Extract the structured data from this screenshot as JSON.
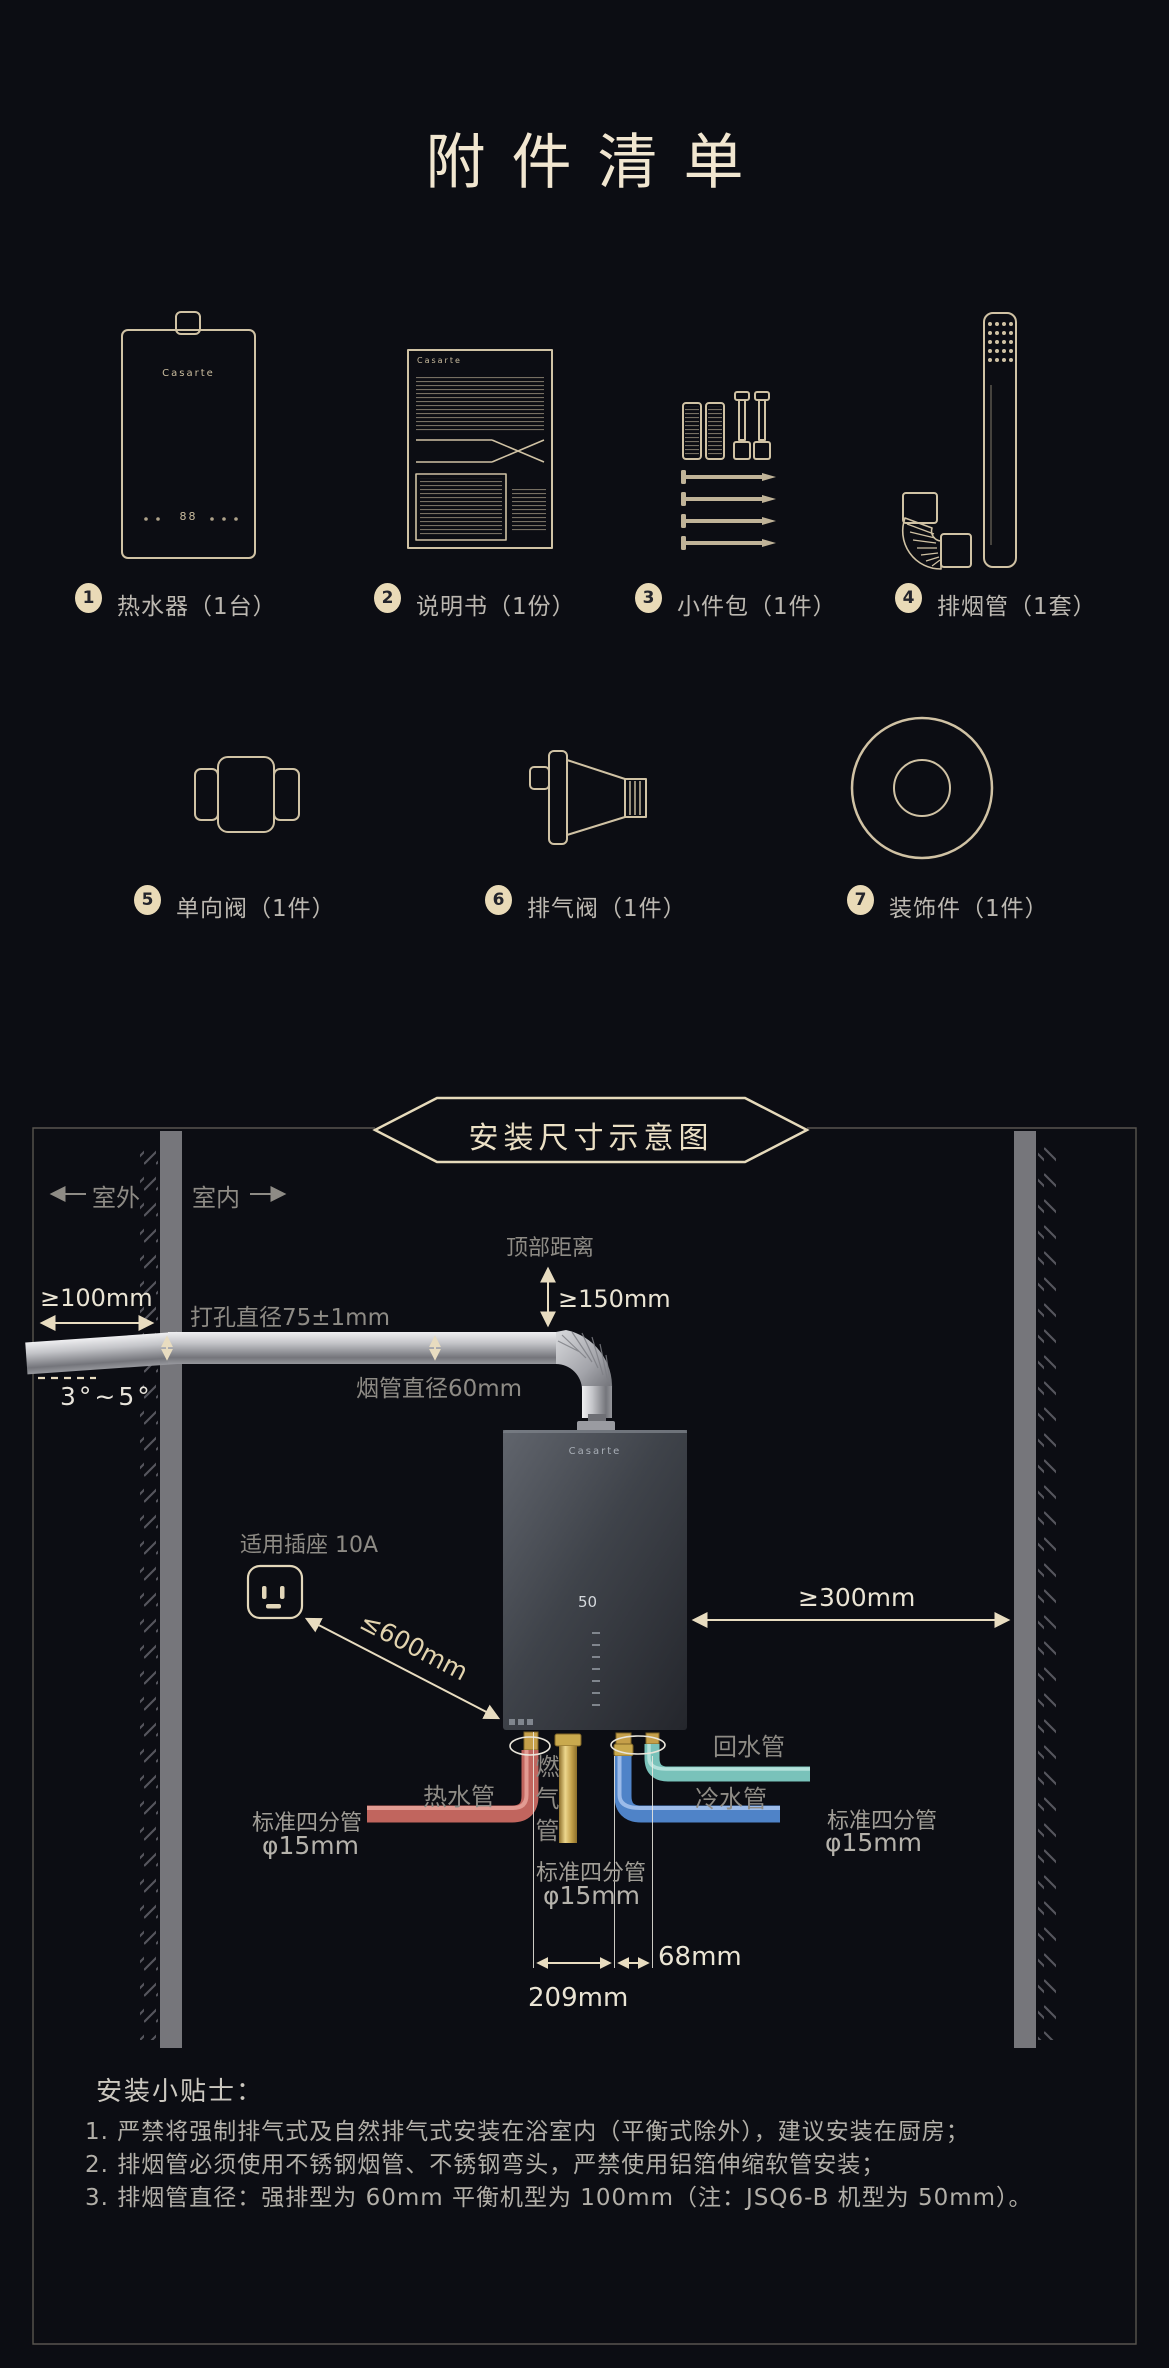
{
  "page": {
    "title": "附件清单",
    "brand": "Casarte"
  },
  "accessories": {
    "heater_display": "88",
    "items": [
      {
        "num": "1",
        "label": "热水器（1台）"
      },
      {
        "num": "2",
        "label": "说明书（1份）"
      },
      {
        "num": "3",
        "label": "小件包（1件）"
      },
      {
        "num": "4",
        "label": "排烟管（1套）"
      },
      {
        "num": "5",
        "label": "单向阀（1件）"
      },
      {
        "num": "6",
        "label": "排气阀（1件）"
      },
      {
        "num": "7",
        "label": "装饰件（1件）"
      }
    ]
  },
  "diagram": {
    "banner": "安装尺寸示意图",
    "outdoor": "室外",
    "indoor": "室内",
    "wall_gap": "≥100mm",
    "hole": "打孔直径75±1mm",
    "angle": "3°~5°",
    "flue_dia": "烟管直径60mm",
    "top_dist": "顶部距离",
    "top_gap": "≥150mm",
    "socket": "适用插座 10A",
    "socket_dist": "≤600mm",
    "side_gap": "≥300mm",
    "heater_temp": "50",
    "hot": "热水管",
    "gas": "燃气管",
    "cold": "冷水管",
    "recirc": "回水管",
    "std_pipe": "标准四分管",
    "phi": "φ15mm",
    "dim209": "209mm",
    "dim68": "68mm"
  },
  "tips": {
    "heading": "安装小贴士：",
    "lines": [
      "1. 严禁将强制排气式及自然排气式安装在浴室内（平衡式除外），建议安装在厨房；",
      "2. 排烟管必须使用不锈钢烟管、不锈钢弯头，严禁使用铝箔伸缩软管安装；",
      "3. 排烟管直径：强排型为 60mm 平衡机型为 100mm（注：JSQ6-B 机型为 50mm）。"
    ]
  },
  "colors": {
    "background": "#0c0d13",
    "outline_cream": "#d0c2a4",
    "dimension_cream": "#e8dcc0",
    "label_gray": "#8e8b85",
    "wall_gray": "#76767b",
    "hot_pipe": "#c1655e",
    "cold_pipe": "#4f83c8",
    "recirc_pipe": "#79c2ba",
    "gas_pipe": "#c9a84c"
  }
}
